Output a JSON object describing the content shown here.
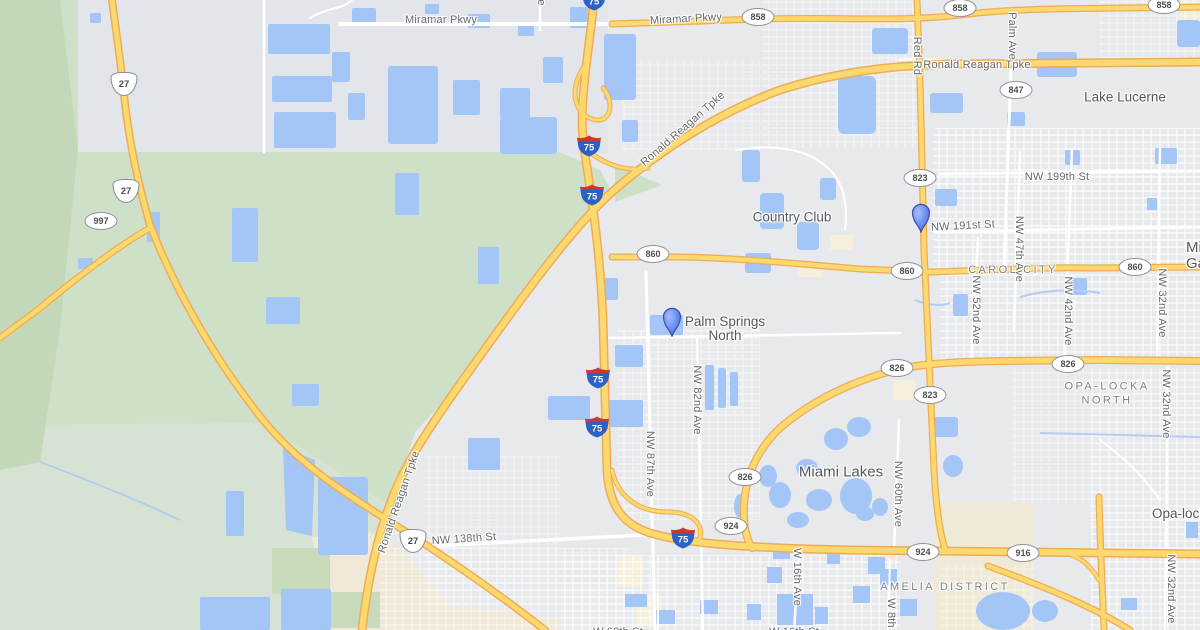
{
  "map": {
    "road_labels": {
      "miramar_pkwy_w": "Miramar Pkwy",
      "miramar_pkwy_e": "Miramar Pkwy",
      "ronald_reagan_h": "Ronald Reagan Tpke",
      "ronald_reagan_diag": "Ronald Reagan Tpke",
      "ronald_reagan_s": "Ronald Reagan Tpke",
      "red_rd": "Red Rd",
      "palm_ave": "Palm Ave",
      "ave_top": "Ave",
      "nw_199th_st": "NW 199th St",
      "nw_191st_st": "NW 191st St",
      "nw_47th_ave": "NW 47th Ave",
      "nw_42nd_ave": "NW 42nd Ave",
      "nw_52nd_ave": "NW 52nd Ave",
      "nw_32nd_ave_n": "NW 32nd Ave",
      "nw_32nd_ave_mid": "NW 32nd Ave",
      "nw_32nd_ave_s": "NW 32nd Ave",
      "nw_87th_ave": "NW 87th Ave",
      "nw_82nd_ave": "NW 82nd Ave",
      "nw_60th_ave": "NW 60th Ave",
      "nw_138th_st": "NW 138th St",
      "w_16th_ave": "W 16th Ave",
      "w_8th_ave": "W 8th Ave",
      "w_60th_st": "W 60th St",
      "w_16th_st": "W 16th St"
    },
    "place_labels": {
      "lake_lucerne": "Lake Lucerne",
      "country_club": "Country Club",
      "palm_springs_north_1": "Palm Springs",
      "palm_springs_north_2": "North",
      "miami_lakes": "Miami Lakes",
      "miami_gardens_1": "Miami",
      "miami_gardens_2": "Gardens",
      "carol_city": "CAROL CITY",
      "opa_locka_north_1": "OPA-LOCKA",
      "opa_locka_north_2": "NORTH",
      "amelia_district": "AMELIA DISTRICT",
      "opa_locka": "Opa-locka"
    },
    "shields": {
      "i75": "75",
      "us27": "27",
      "sr858": "858",
      "sr847": "847",
      "sr823": "823",
      "sr860": "860",
      "sr826": "826",
      "sr924": "924",
      "sr916": "916",
      "sr997": "997"
    },
    "colors": {
      "water": "#a3c6f7",
      "land_gray": "#e7e9ec",
      "park_green": "#cfe0c8",
      "park_green_pale": "#d6e2d3",
      "sand": "#f0e9d8",
      "highway_yellow": "#fcd96f",
      "highway_casing": "#f0ab55",
      "marker_blue": "#6d8ff3",
      "interstate_blue": "#2d62c5",
      "interstate_red": "#c8392f"
    }
  }
}
